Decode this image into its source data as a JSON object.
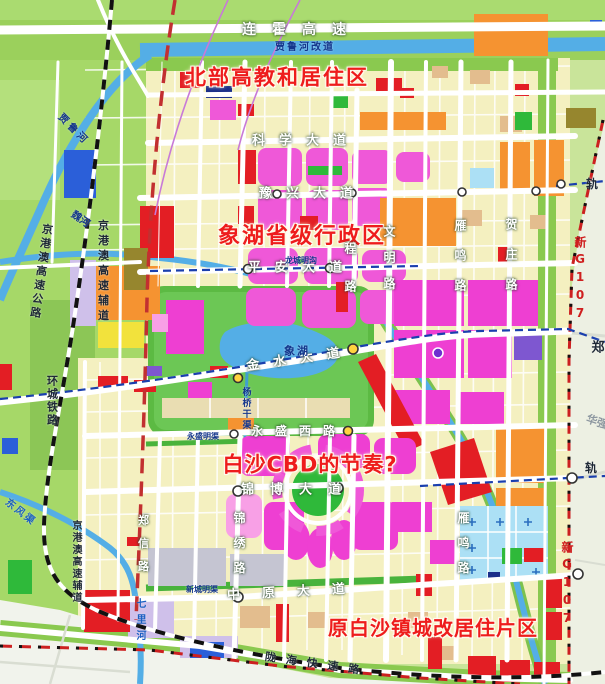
{
  "regions": [
    {
      "text": "北部高教和居住区"
    },
    {
      "text": "象湖省级行政区"
    },
    {
      "text": "白沙CBD的节奏?"
    },
    {
      "text": "原白沙镇城改居住片区"
    }
  ],
  "roads": [
    {
      "text": "连霍高速"
    },
    {
      "text": "科学大道"
    },
    {
      "text": "豫兴大道"
    },
    {
      "text": "平安大道"
    },
    {
      "text": "金水大道"
    },
    {
      "text": "永盛西路"
    },
    {
      "text": "锦博大道"
    },
    {
      "text": "中原大道"
    },
    {
      "text": "陇海快速路"
    },
    {
      "text": "文明路"
    },
    {
      "text": "程路"
    },
    {
      "text": "锦绣路"
    },
    {
      "text": "郑信路"
    },
    {
      "text": "雁鸣路"
    },
    {
      "text": "贺庄路"
    },
    {
      "text": "新G107"
    }
  ],
  "rails": [
    {
      "text": "京港澳高速公路"
    },
    {
      "text": "京港澳高速辅道"
    },
    {
      "text": "环城铁路"
    },
    {
      "text": "轨"
    },
    {
      "text": "郑"
    },
    {
      "text": "华强"
    }
  ],
  "waters": [
    {
      "text": "贾鲁河改道"
    },
    {
      "text": "贾鲁河"
    },
    {
      "text": "魏河"
    },
    {
      "text": "象湖"
    },
    {
      "text": "龙城明沟"
    },
    {
      "text": "永盛明渠"
    },
    {
      "text": "新城明渠"
    },
    {
      "text": "杨桥干渠"
    },
    {
      "text": "东风渠"
    },
    {
      "text": "七里河"
    }
  ],
  "colors": {
    "background": "#c9e49a",
    "urban_parcel": "#f4f0c0",
    "residential_magenta": "#ee3fd2",
    "commercial_red": "#e31e24",
    "industry_orange": "#f59331",
    "park_green": "#5cba43",
    "water_blue": "#54aee6",
    "boulevard_green": "#8ac94f",
    "annotation_red": "#ee1c1c",
    "boundary_red": "#cc2020",
    "railway_black": "#111111"
  }
}
